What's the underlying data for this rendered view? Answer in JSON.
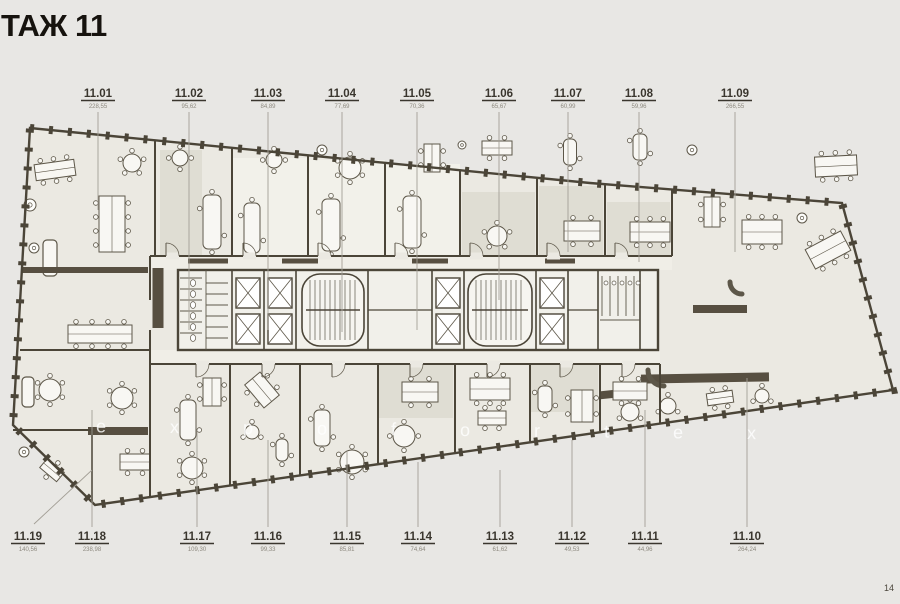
{
  "title": "ТАЖ 11",
  "watermark": "expofortex",
  "page_mark": "14",
  "units": {
    "top": [
      {
        "id": "11.01",
        "area": "228,55"
      },
      {
        "id": "11.02",
        "area": "95,62"
      },
      {
        "id": "11.03",
        "area": "84,89"
      },
      {
        "id": "11.04",
        "area": "77,69"
      },
      {
        "id": "11.05",
        "area": "70,36"
      },
      {
        "id": "11.06",
        "area": "65,67"
      },
      {
        "id": "11.07",
        "area": "60,99"
      },
      {
        "id": "11.08",
        "area": "59,96"
      },
      {
        "id": "11.09",
        "area": "266,55"
      }
    ],
    "bottom": [
      {
        "id": "11.19",
        "area": "140,56"
      },
      {
        "id": "11.18",
        "area": "238,98"
      },
      {
        "id": "11.17",
        "area": "109,30"
      },
      {
        "id": "11.16",
        "area": "99,33"
      },
      {
        "id": "11.15",
        "area": "85,81"
      },
      {
        "id": "11.14",
        "area": "74,64"
      },
      {
        "id": "11.13",
        "area": "61,62"
      },
      {
        "id": "11.12",
        "area": "49,53"
      },
      {
        "id": "11.11",
        "area": "44,96"
      },
      {
        "id": "11.10",
        "area": "264,24"
      }
    ]
  }
}
